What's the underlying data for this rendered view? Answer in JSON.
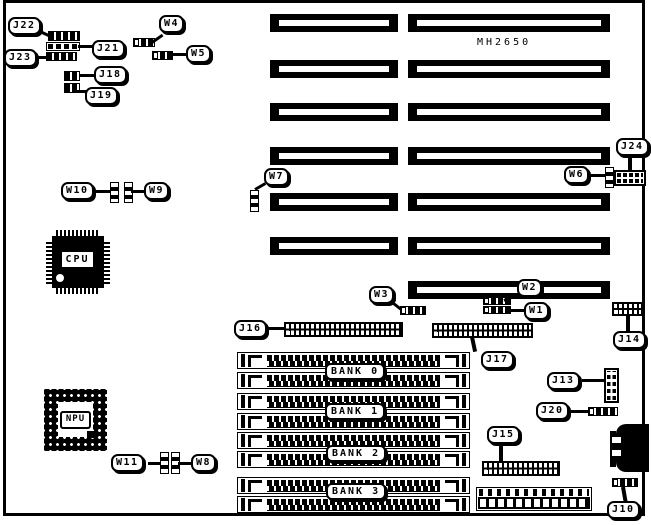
{
  "board": {
    "model": "MH2650"
  },
  "chips": {
    "cpu": "CPU",
    "npu": "NPU"
  },
  "banks": [
    "BANK 0",
    "BANK 1",
    "BANK 2",
    "BANK 3"
  ],
  "jumpers": {
    "w1": "W1",
    "w2": "W2",
    "w3": "W3",
    "w4": "W4",
    "w5": "W5",
    "w6": "W6",
    "w7": "W7",
    "w8": "W8",
    "w9": "W9",
    "w10": "W10",
    "w11": "W11"
  },
  "connectors": {
    "j10": "J10",
    "j13": "J13",
    "j14": "J14",
    "j15": "J15",
    "j16": "J16",
    "j17": "J17",
    "j18": "J18",
    "j19": "J19",
    "j20": "J20",
    "j21": "J21",
    "j22": "J22",
    "j23": "J23",
    "j24": "J24"
  },
  "colors": {
    "ink": "#000000",
    "paper": "#ffffff"
  }
}
